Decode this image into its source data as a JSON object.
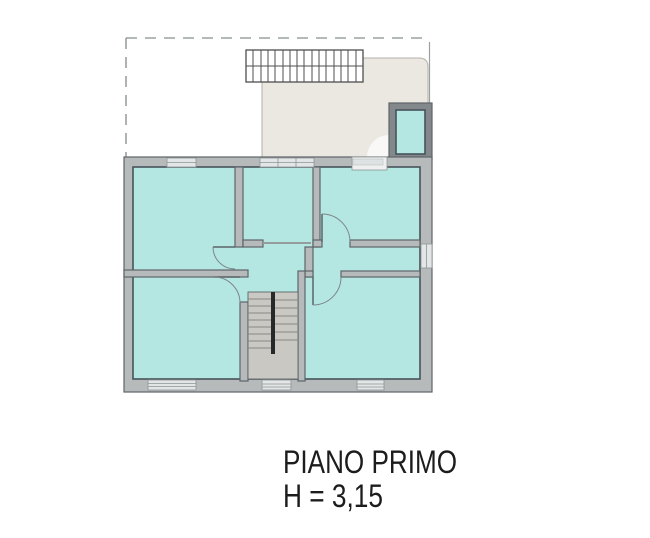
{
  "plan": {
    "title": "PIANO PRIMO",
    "height_label": "H = 3,15",
    "colors": {
      "background": "#ffffff",
      "room_fill": "#b4e6e2",
      "room_edge": "#46535a",
      "wall_fill": "#b6babb",
      "wall_edge": "#5d6568",
      "terrace_fill": "#ebe7e1",
      "terrace_edge": "#b5b1a9",
      "small_room_wall": "#82888b",
      "stair_fill": "#cac8c3",
      "stair_tread": "#8a8883",
      "stair_rail": "#26292a",
      "window_fill": "#e3e6e6",
      "window_edge": "#8e9496",
      "dashed_line": "#9aa0a0",
      "pergola_line": "#4f4f4f",
      "text": "#1c1c1c"
    }
  }
}
